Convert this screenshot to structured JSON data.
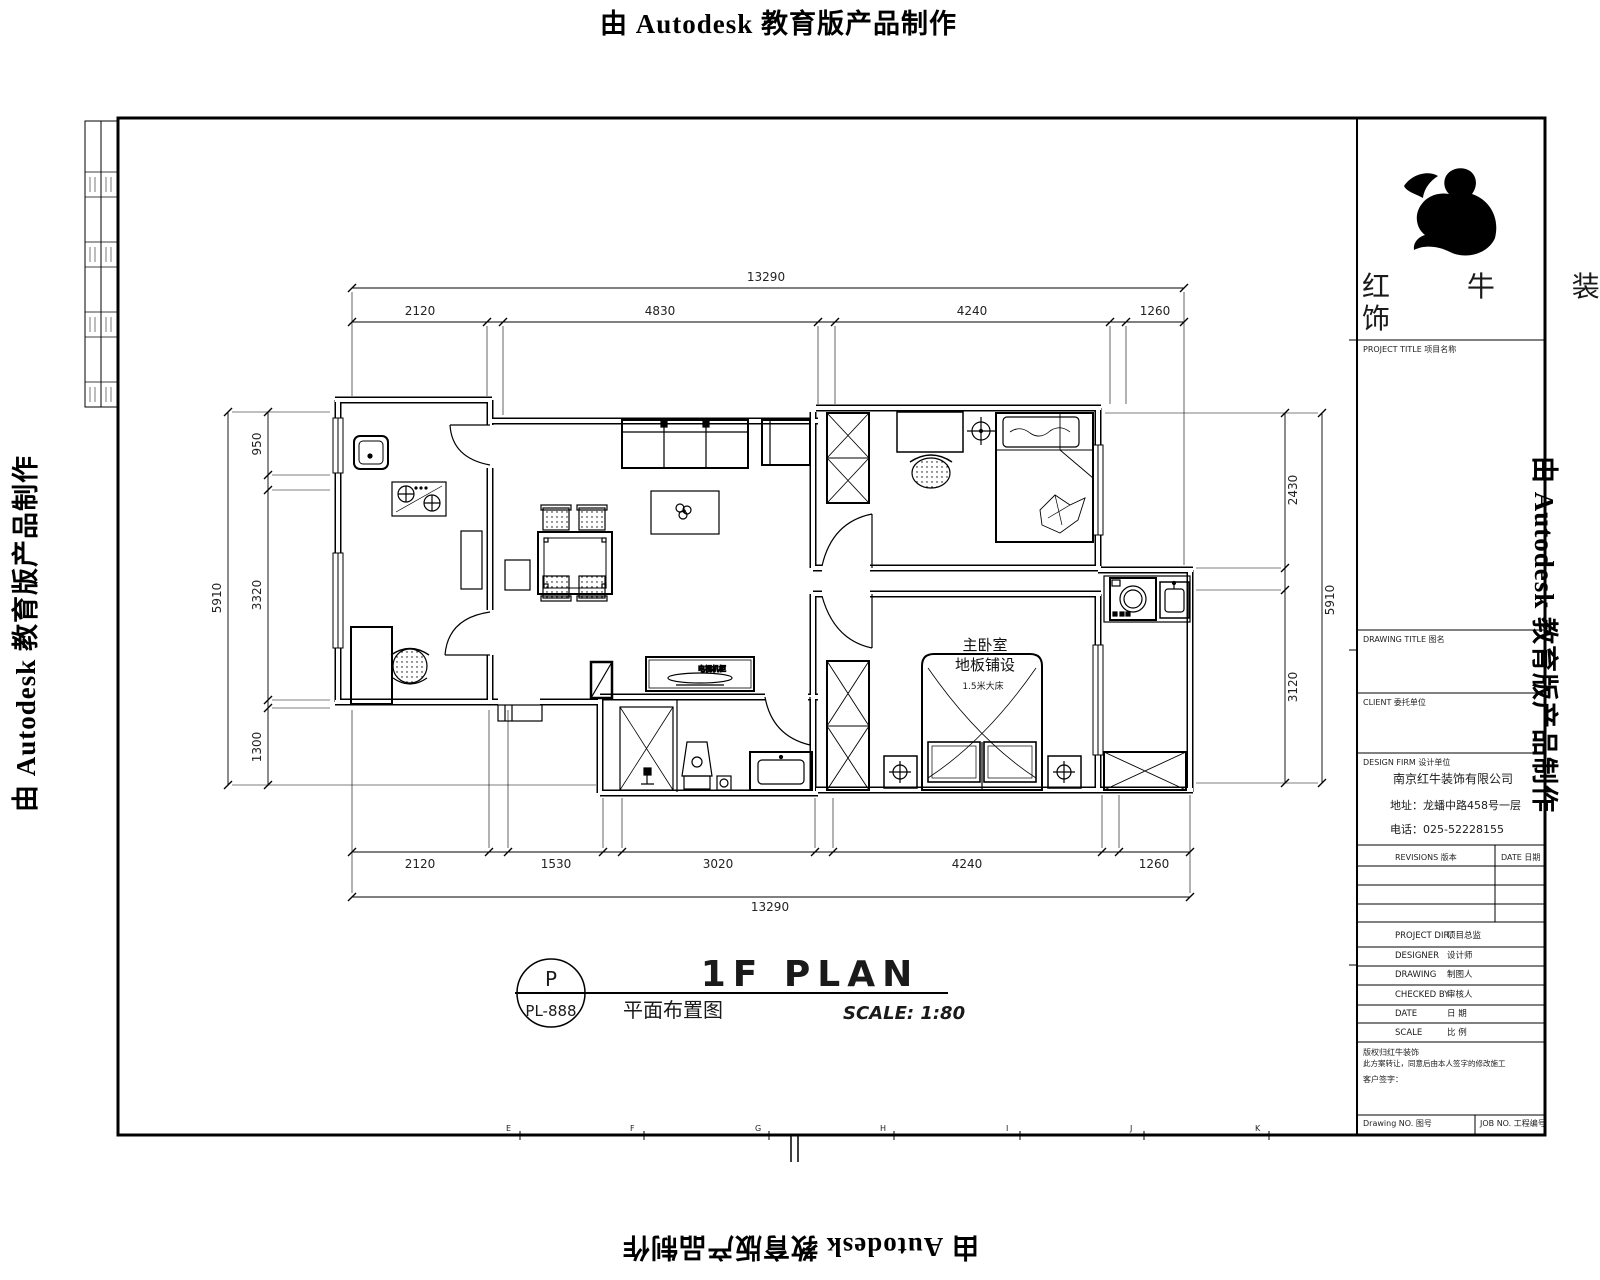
{
  "banner": {
    "text": "由 Autodesk 教育版产品制作"
  },
  "titleblock": {
    "brand_line1": "红 牛 装",
    "brand_line2": "饰",
    "project_title_label": "PROJECT TITLE   项目名称",
    "drawing_title_label": "DRAWING TITLE   图名",
    "client_label": "CLIENT   委托单位",
    "design_firm_label": "DESIGN FIRM   设计单位",
    "company_name": "南京红牛装饰有限公司",
    "company_address": "地址：龙蟠中路458号一层",
    "company_phone": "电话：025-52228155",
    "revisions_label": "REVISIONS 版本",
    "revisions_date_label": "DATE 日期",
    "rows": [
      {
        "en": "PROJECT DIR.",
        "cn": "项目总监"
      },
      {
        "en": "DESIGNER",
        "cn": "设计师"
      },
      {
        "en": "DRAWING",
        "cn": "制图人"
      },
      {
        "en": "CHECKED BY",
        "cn": "审核人"
      },
      {
        "en": "DATE",
        "cn": "日 期"
      },
      {
        "en": "SCALE",
        "cn": "比 例"
      }
    ],
    "disclaimer1": "版权归红牛装饰",
    "disclaimer2": "此方案转让，同意后由本人签字的修改施工",
    "disclaimer3": "客户签字：",
    "drawing_no_label": "Drawing NO. 图号",
    "job_no_label": "JOB NO. 工程编号"
  },
  "plan": {
    "room": {
      "name": "主卧室",
      "floor": "地板铺设",
      "bed": "1.5米大床"
    },
    "tv_label": "电视机柜",
    "dims": {
      "top_overall": "13290",
      "top": [
        "2120",
        "4830",
        "4240",
        "1260"
      ],
      "bottom": [
        "2120",
        "1530",
        "3020",
        "4240",
        "1260"
      ],
      "bottom_overall": "13290",
      "left": [
        "950",
        "3320",
        "1300"
      ],
      "left_overall": "5910",
      "right": [
        "2430",
        "3120"
      ],
      "right_overall": "5910"
    }
  },
  "titlebar": {
    "plan_title": "1F PLAN",
    "plan_title_cn": "平面布置图",
    "scale": "SCALE: 1:80",
    "tag_top": "P",
    "tag_bottom": "PL-888"
  },
  "grid_letters": [
    "E",
    "F",
    "G",
    "H",
    "I",
    "J",
    "K"
  ]
}
